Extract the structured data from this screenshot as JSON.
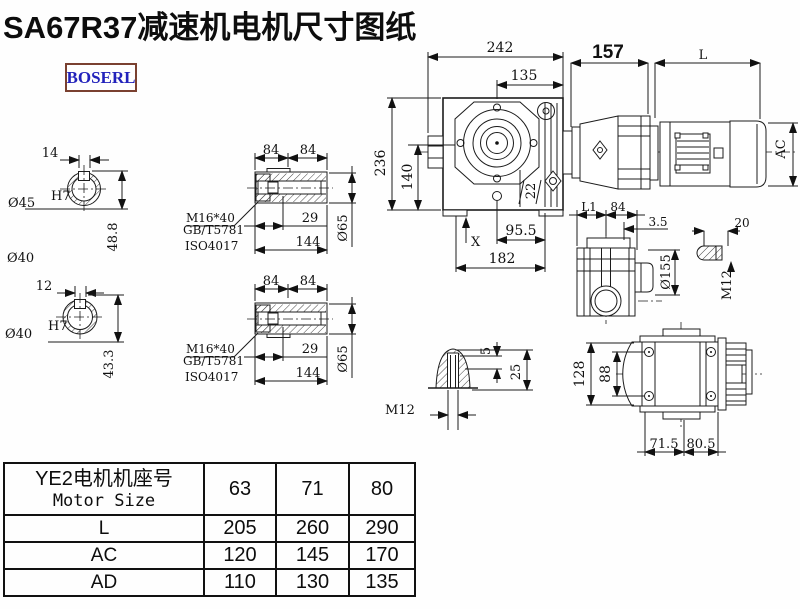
{
  "title": "SA67R37减速机电机尺寸图纸",
  "logo": "BOSERL",
  "drawing": {
    "shaft1": {
      "width": "14",
      "bore": "Ø45",
      "tol": "H7",
      "height": "48.8",
      "outer": "Ø40"
    },
    "shaft2": {
      "width": "12",
      "bore": "Ø40",
      "tol": "H7",
      "height": "43.3"
    },
    "sleeve1": {
      "seg1": "84",
      "seg2": "84",
      "depth": "29",
      "length": "144",
      "dia": "Ø65",
      "bolt": "M16*40",
      "std1": "GB/T5781",
      "std2": "ISO4017"
    },
    "sleeve2": {
      "seg1": "84",
      "seg2": "84",
      "depth": "29",
      "length": "144",
      "dia": "Ø65",
      "bolt": "M16*40",
      "std1": "GB/T5781",
      "std2": "ISO4017"
    },
    "main": {
      "width": "242",
      "face": "135",
      "adapter": "157",
      "motor_len": "L",
      "height": "236",
      "axis_height": "140",
      "foot": "22",
      "base1": "95.5",
      "base2": "182",
      "mark": "X",
      "motor_dia": "AC"
    },
    "side": {
      "l1": "L1",
      "w": "84",
      "offset": "3.5",
      "lug": "20",
      "flange": "Ø155",
      "thread": "M12"
    },
    "dome": {
      "thread": "M12",
      "t1": "5",
      "t2": "25"
    },
    "bottom": {
      "h1": "128",
      "h2": "88",
      "b1": "71.5",
      "b2": "80.5"
    }
  },
  "table": {
    "header_cn": "YE2电机机座号",
    "header_en": "Motor Size",
    "sizes": [
      "63",
      "71",
      "80"
    ],
    "rows": [
      {
        "label": "L",
        "values": [
          "205",
          "260",
          "290"
        ]
      },
      {
        "label": "AC",
        "values": [
          "120",
          "145",
          "170"
        ]
      },
      {
        "label": "AD",
        "values": [
          "110",
          "130",
          "135"
        ]
      }
    ]
  }
}
